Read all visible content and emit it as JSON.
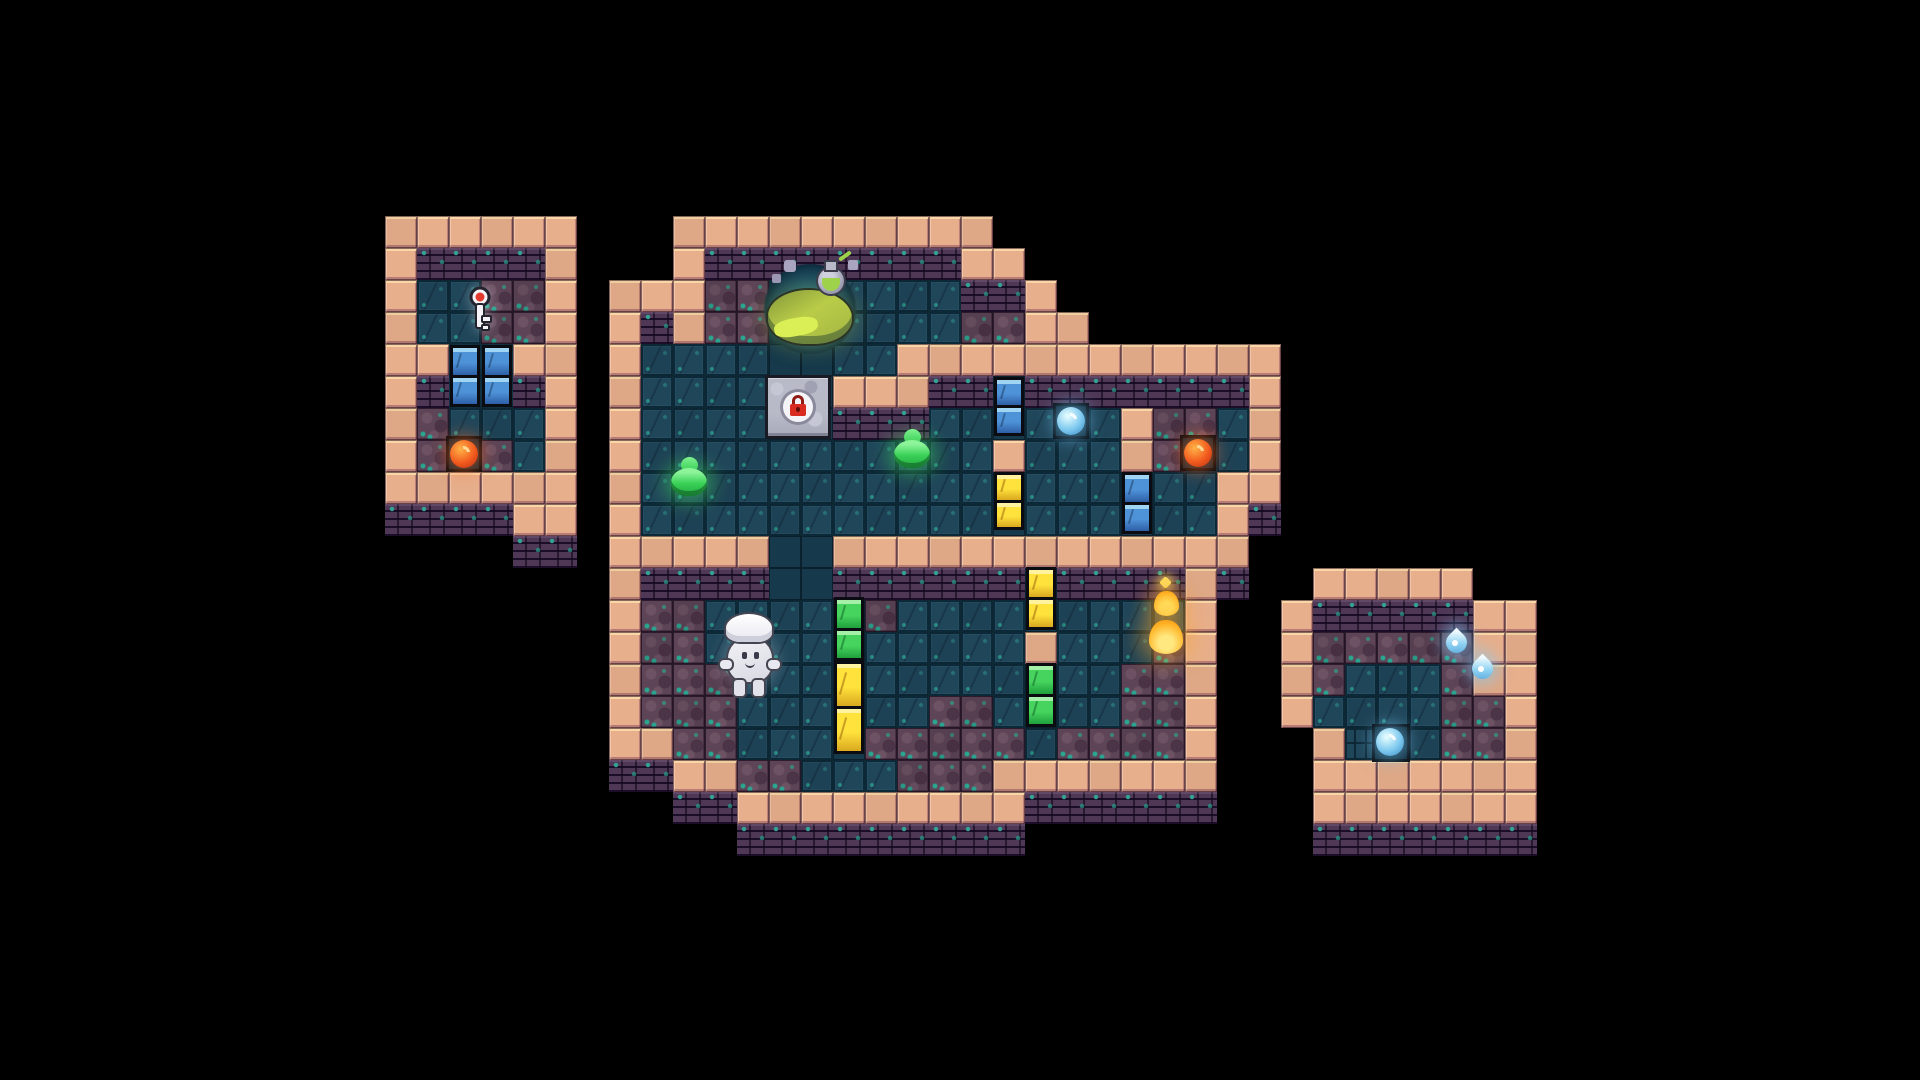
{
  "scene": {
    "name": "pixel-dungeon-map",
    "background": "#000000",
    "tile_size": 32,
    "origin_x": 385,
    "origin_y": 216
  },
  "palette": {
    "wall": "#e7af8c",
    "wall_light": "#f8d6a6",
    "wall_face": "#2c1b39",
    "floor": "#20465a",
    "floor_dark": "#16394b",
    "dirt": "#5d4456",
    "moss": "#2ba58f",
    "door_blue": "#4e92d8",
    "door_yellow": "#ffe23c",
    "door_green": "#46d45e",
    "orb_red": "#f25a1e",
    "slime_green": "#3ad158",
    "water_blue": "#8fd2f2",
    "flame_gold": "#ffb224",
    "player_white": "#f2f2f6",
    "cauldron_green": "#b9cc48"
  },
  "tilemap": {
    "legend": {
      "W": "wall",
      "F": "wall-face",
      "t": "floor",
      "s": "floor-dark",
      "f": "floor-fine",
      "d": "dirt",
      "v": "pit",
      ".": "void"
    },
    "rows": [
      "WWWWWW...WWWWWWWWWW.................",
      "WFFFFW...WFFFFFFFFWW................",
      "WttddW.WWWddvvttttFFW...............",
      "WttddW.WFWddvvttttddWW..............",
      "WWvvWW.WttttssttWWWWWWWWWWWW........",
      "WFvvFW.WttttssWWWFFsFFFFFFFW........",
      "WdtttW.WttttssFFFttstttWddtW........",
      "WdtdtW.WtttttttttttWtttWdttW........",
      "WWWWWW.WtttttttttttstttsttWW........",
      "FFFFWW.WtttttttttttstttsttWF........",
      "....FF.WWWWWssWWWWWWWWWWWWW.........",
      ".......WFFFFssFFFFFFsFFFFWF..WWWWW..",
      ".......WddttttsdttttsttttW..WFFFFFWW",
      ".......WddttttstttttWtttdW..WdddddWW",
      ".......WdddtttstttttsttddW..WdtttdWW",
      ".......WdddtttsttddtsttddW..WttttddW",
      ".......WWddtttsdddddtddddW...WfftddW",
      ".......FFWWddtttdddWWWWWWW...WWWWWWW",
      ".........FFWWWWWWWWWFFFFFF...WWWWWWW",
      "...........FFFFFFFFF.........FFFFFFF"
    ]
  },
  "doors": [
    {
      "name": "left-room-gate-left",
      "color": "blue",
      "x": 450,
      "y": 345,
      "w": 30,
      "h": 62,
      "segments": 2
    },
    {
      "name": "left-room-gate-right",
      "color": "blue",
      "x": 482,
      "y": 345,
      "w": 30,
      "h": 62,
      "segments": 2
    },
    {
      "name": "blue-door-upper",
      "color": "blue",
      "x": 994,
      "y": 377,
      "w": 30,
      "h": 59,
      "segments": 2
    },
    {
      "name": "yellow-door-mid",
      "color": "yellow",
      "x": 994,
      "y": 472,
      "w": 30,
      "h": 58,
      "segments": 2
    },
    {
      "name": "blue-door-right",
      "color": "blue",
      "x": 1122,
      "y": 472,
      "w": 30,
      "h": 62,
      "segments": 2
    },
    {
      "name": "yellow-door-east",
      "color": "yellow",
      "x": 1026,
      "y": 567,
      "w": 30,
      "h": 63,
      "segments": 2
    },
    {
      "name": "green-door-west",
      "color": "green",
      "x": 834,
      "y": 597,
      "w": 30,
      "h": 64,
      "segments": 2
    },
    {
      "name": "yellow-door-west",
      "color": "yellow",
      "x": 834,
      "y": 661,
      "w": 30,
      "h": 93,
      "segments": 2
    },
    {
      "name": "green-door-east",
      "color": "green",
      "x": 1026,
      "y": 663,
      "w": 30,
      "h": 64,
      "segments": 2
    }
  ],
  "entities": [
    {
      "type": "cauldron",
      "name": "cauldron-with-potion",
      "x": 760,
      "y": 260,
      "w": 100,
      "h": 96
    },
    {
      "type": "lockdoor",
      "name": "locked-stone-door",
      "x": 765,
      "y": 375,
      "w": 66,
      "h": 64
    },
    {
      "type": "key",
      "name": "key-item",
      "x": 463,
      "y": 286,
      "w": 34,
      "h": 48
    },
    {
      "type": "orb",
      "variant": "red",
      "name": "red-orb-item",
      "x": 446,
      "y": 436,
      "w": 36,
      "h": 36
    },
    {
      "type": "orb",
      "variant": "blue",
      "name": "blue-orb-item",
      "x": 1053,
      "y": 403,
      "w": 36,
      "h": 36
    },
    {
      "type": "orb",
      "variant": "red",
      "name": "red-orb-item",
      "x": 1180,
      "y": 435,
      "w": 36,
      "h": 36
    },
    {
      "type": "orb",
      "variant": "blue",
      "name": "blue-orb-item",
      "x": 1372,
      "y": 724,
      "w": 38,
      "h": 38
    },
    {
      "type": "slime",
      "name": "green-slime",
      "x": 666,
      "y": 452,
      "w": 48,
      "h": 52
    },
    {
      "type": "slime",
      "name": "green-slime",
      "x": 889,
      "y": 424,
      "w": 44,
      "h": 50
    },
    {
      "type": "drop",
      "name": "water-drop",
      "x": 1442,
      "y": 622,
      "w": 30,
      "h": 42
    },
    {
      "type": "drop",
      "name": "water-drop",
      "x": 1468,
      "y": 648,
      "w": 34,
      "h": 46
    },
    {
      "type": "flame",
      "name": "flame-spirit",
      "x": 1144,
      "y": 578,
      "w": 46,
      "h": 82
    },
    {
      "type": "player",
      "name": "player-character",
      "x": 720,
      "y": 614,
      "w": 60,
      "h": 84
    }
  ]
}
